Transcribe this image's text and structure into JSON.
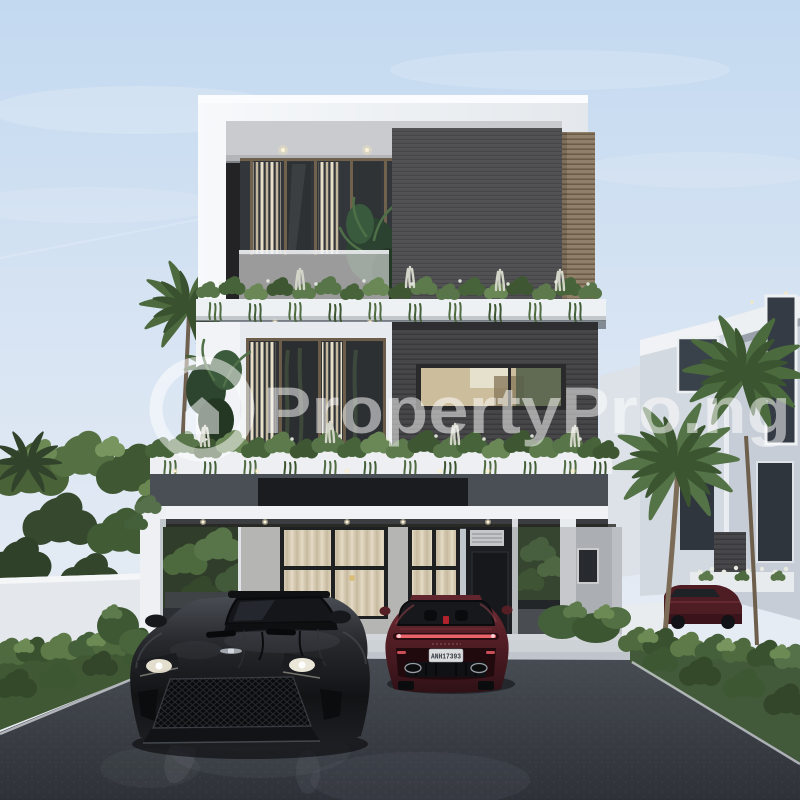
{
  "scene": {
    "type": "property-listing-photograph",
    "description": "Front elevation rendering at dusk of a modern three-storey white-and-dark-grey duplex with cascading planter greenery, a carport, palm trees, trimmed hedges and two sports cars parked on a dark asphalt driveway"
  },
  "watermark": {
    "text": "PropertyPro.ng",
    "logo": "ring-with-house",
    "color": "#ffffff"
  },
  "vehicles": {
    "black_car": {
      "description": "black sports coupe, front view, headlights on"
    },
    "red_car": {
      "description": "dark red sports coupe, rear view",
      "license_plate": "ANH17393"
    },
    "distant_car": {
      "description": "dark red car parked beside neighbouring house"
    }
  },
  "palette": {
    "sky_top": "#c3d9f0",
    "sky_bottom": "#edf0f4",
    "facade_white": "#f3f5f7",
    "cladding_dark_gray": "#4a4a4d",
    "cladding_brown": "#8f7f69",
    "foliage_green": "#4e6a3e",
    "asphalt": "#383c42",
    "black_car_paint": "#1b1c1f",
    "red_car_paint": "#572028"
  }
}
